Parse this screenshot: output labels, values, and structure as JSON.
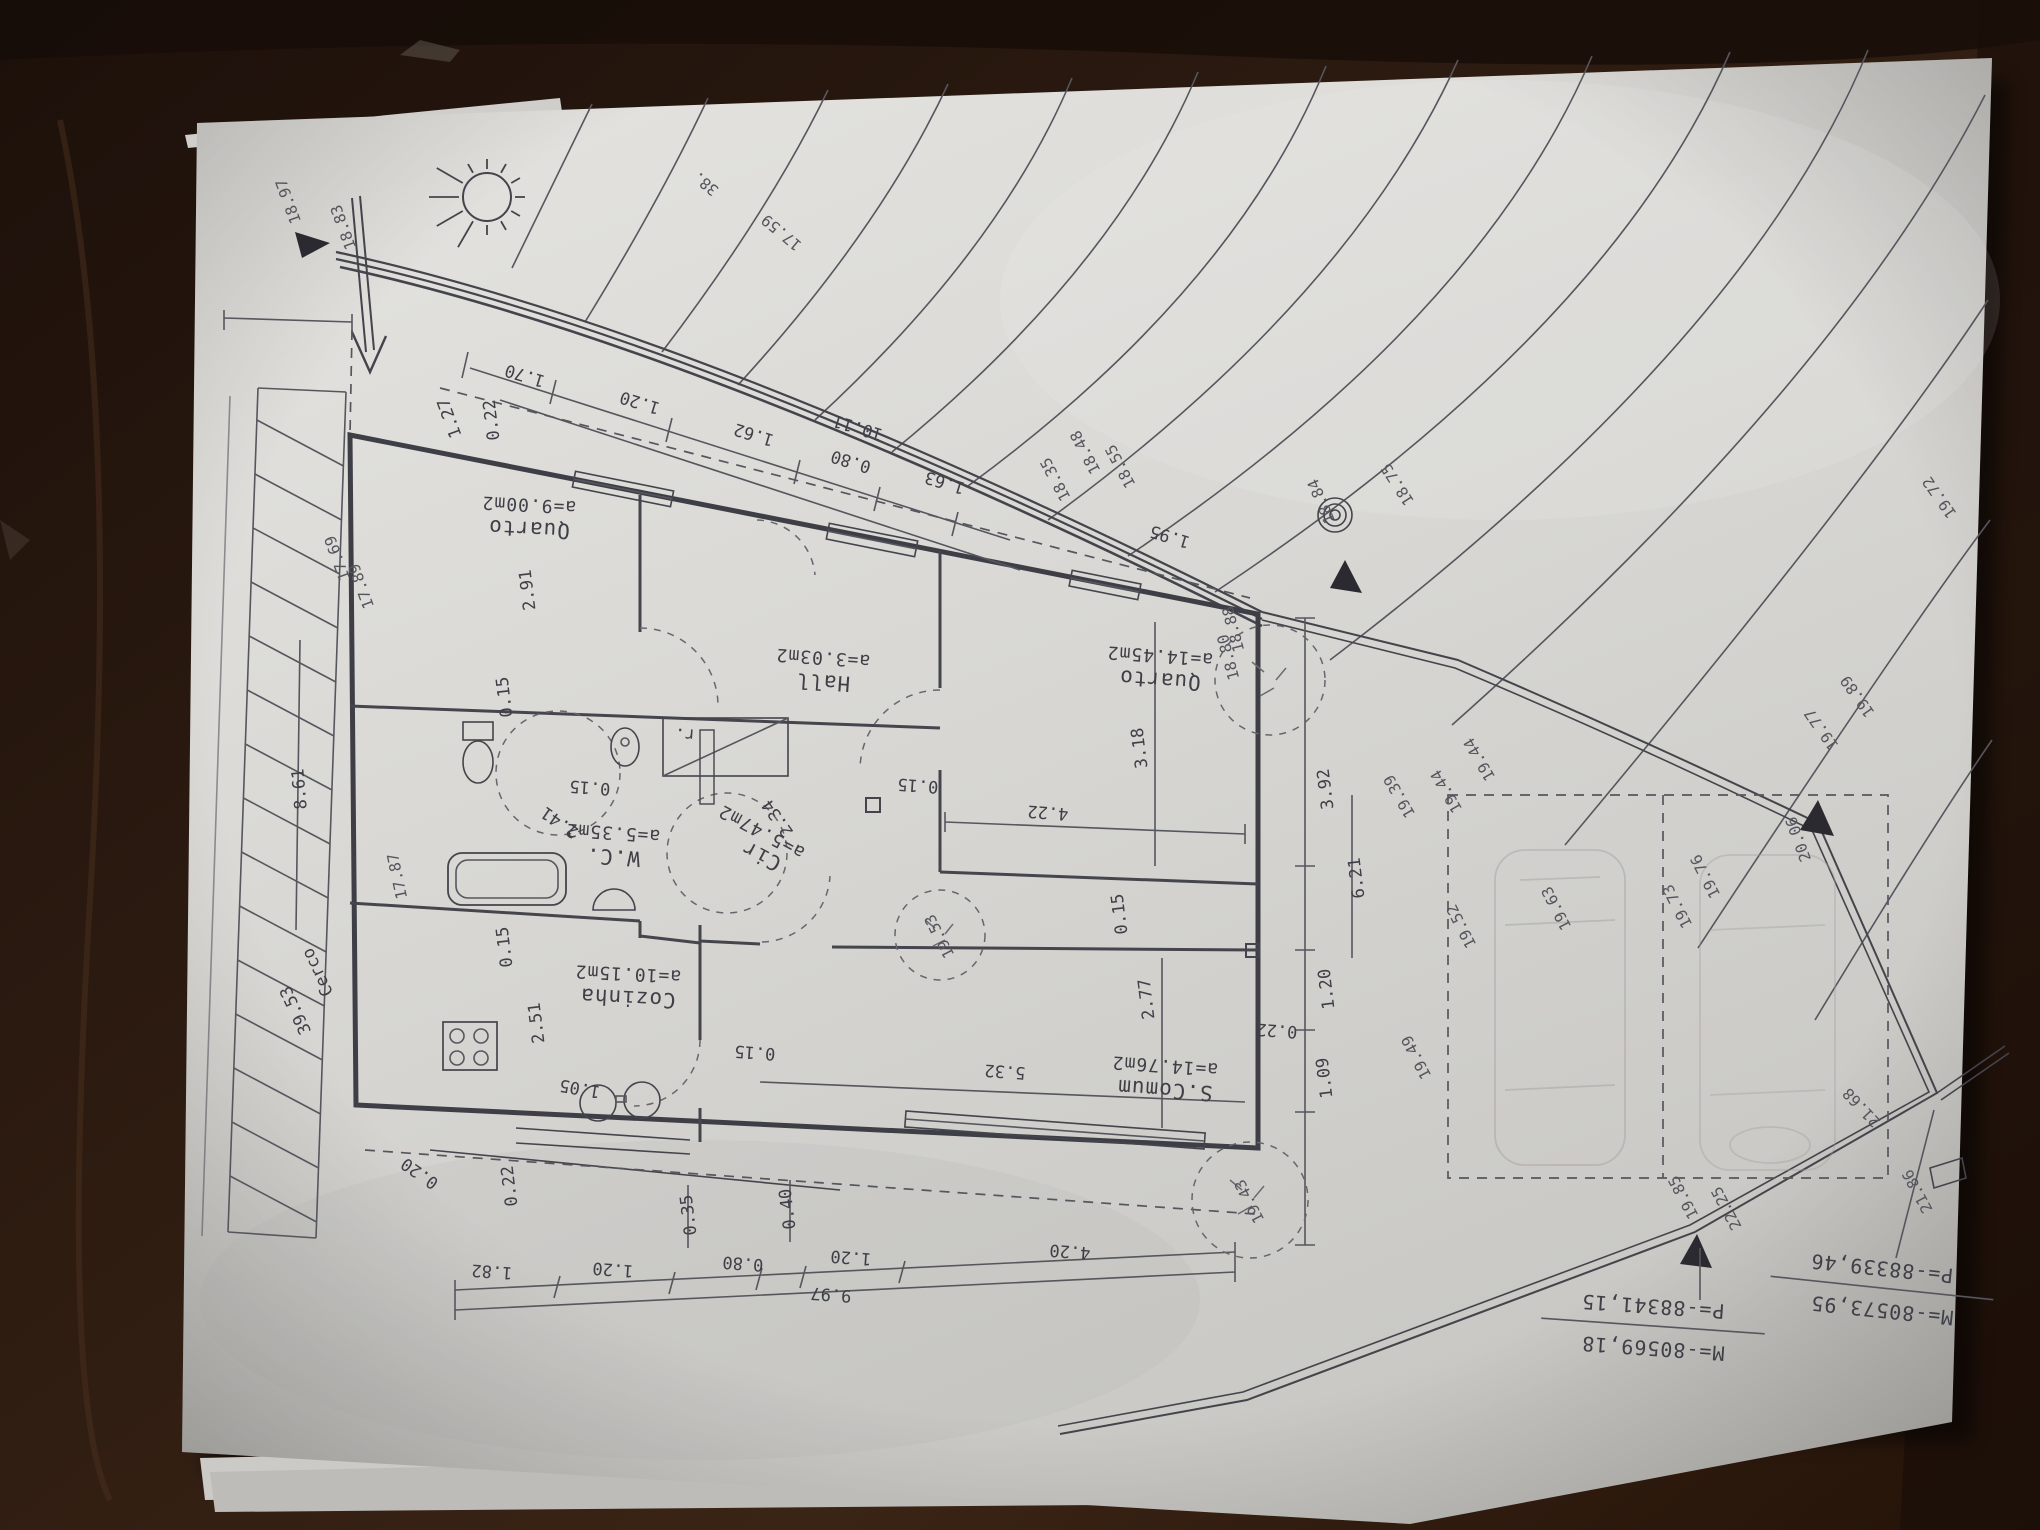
{
  "scene": {
    "description_labels": [],
    "paper_color": "#dbdad6",
    "wood_color": "#261710",
    "ink_color": "#3f3f47"
  },
  "plan": {
    "rooms": [
      {
        "name": "Quarto",
        "area": "a=9.00m2",
        "x": 529,
        "y": 516,
        "a": 183
      },
      {
        "name": "Hall",
        "area": "a=3.03m2",
        "x": 823,
        "y": 669,
        "a": 184
      },
      {
        "name": "Quarto",
        "area": "a=14.45m2",
        "x": 1160,
        "y": 667,
        "a": 184
      },
      {
        "name": "W.C.",
        "area": "a=5.35m2",
        "x": 613,
        "y": 844,
        "a": 184
      },
      {
        "name": "Cir",
        "area": "a=5.47m2",
        "x": 762,
        "y": 843,
        "a": 208
      },
      {
        "name": "Cozinha",
        "area": "a=10.15m2",
        "x": 628,
        "y": 985,
        "a": 183
      },
      {
        "name": "S.Comum",
        "area": "a=14.76m2",
        "x": 1165,
        "y": 1077,
        "a": 184
      }
    ],
    "dimensions": [
      {
        "t": "0.22",
        "x": 492,
        "y": 420,
        "a": 263
      },
      {
        "t": "1.70",
        "x": 525,
        "y": 375,
        "a": 197
      },
      {
        "t": "1.20",
        "x": 640,
        "y": 402,
        "a": 197
      },
      {
        "t": "1.62",
        "x": 754,
        "y": 434,
        "a": 197
      },
      {
        "t": "10.11",
        "x": 858,
        "y": 427,
        "a": 197
      },
      {
        "t": "0.80",
        "x": 851,
        "y": 461,
        "a": 197
      },
      {
        "t": "1.63",
        "x": 945,
        "y": 482,
        "a": 197
      },
      {
        "t": "1.95",
        "x": 1170,
        "y": 536,
        "a": 197
      },
      {
        "t": "2.91",
        "x": 528,
        "y": 590,
        "a": 263
      },
      {
        "t": "0.15",
        "x": 505,
        "y": 697,
        "a": 263
      },
      {
        "t": "0.15",
        "x": 590,
        "y": 787,
        "a": 184
      },
      {
        "t": "0.15",
        "x": 918,
        "y": 785,
        "a": 184
      },
      {
        "t": "r.",
        "x": 685,
        "y": 734,
        "a": 184
      },
      {
        "t": "3.18",
        "x": 1140,
        "y": 748,
        "a": 263
      },
      {
        "t": "4.22",
        "x": 1048,
        "y": 812,
        "a": 184
      },
      {
        "t": "2.41",
        "x": 560,
        "y": 822,
        "a": 215
      },
      {
        "t": "2.34",
        "x": 778,
        "y": 818,
        "a": 235
      },
      {
        "t": "0.15",
        "x": 505,
        "y": 947,
        "a": 263
      },
      {
        "t": "0.15",
        "x": 755,
        "y": 1052,
        "a": 184
      },
      {
        "t": "0.15",
        "x": 1120,
        "y": 914,
        "a": 263
      },
      {
        "t": "2.51",
        "x": 537,
        "y": 1023,
        "a": 263
      },
      {
        "t": "1.05",
        "x": 580,
        "y": 1088,
        "a": 190
      },
      {
        "t": "2.77",
        "x": 1147,
        "y": 999,
        "a": 263
      },
      {
        "t": "5.32",
        "x": 1005,
        "y": 1071,
        "a": 184
      },
      {
        "t": "3.92",
        "x": 1326,
        "y": 789,
        "a": 263
      },
      {
        "t": "6.21",
        "x": 1357,
        "y": 878,
        "a": 263
      },
      {
        "t": "1.20",
        "x": 1327,
        "y": 989,
        "a": 263
      },
      {
        "t": "0.22",
        "x": 1277,
        "y": 1030,
        "a": 184
      },
      {
        "t": "1.09",
        "x": 1325,
        "y": 1078,
        "a": 263
      },
      {
        "t": "0.22",
        "x": 510,
        "y": 1186,
        "a": 263
      },
      {
        "t": "0.20",
        "x": 420,
        "y": 1173,
        "a": 215
      },
      {
        "t": "1.82",
        "x": 492,
        "y": 1271,
        "a": 184
      },
      {
        "t": "1.20",
        "x": 613,
        "y": 1269,
        "a": 184
      },
      {
        "t": "0.80",
        "x": 743,
        "y": 1263,
        "a": 184
      },
      {
        "t": "0.35",
        "x": 689,
        "y": 1215,
        "a": 263
      },
      {
        "t": "0.40",
        "x": 788,
        "y": 1209,
        "a": 263
      },
      {
        "t": "1.20",
        "x": 851,
        "y": 1257,
        "a": 184
      },
      {
        "t": "4.20",
        "x": 1070,
        "y": 1251,
        "a": 184
      },
      {
        "t": "9.97",
        "x": 831,
        "y": 1294,
        "a": 184
      },
      {
        "t": "8.61",
        "x": 300,
        "y": 789,
        "a": 265
      },
      {
        "t": "39.53",
        "x": 296,
        "y": 1010,
        "a": 245
      },
      {
        "t": "Cerco",
        "x": 318,
        "y": 972,
        "a": 245
      },
      {
        "t": "1.27",
        "x": 450,
        "y": 418,
        "a": 250
      }
    ],
    "elevations": [
      {
        "t": "18.97",
        "x": 289,
        "y": 201,
        "a": 250
      },
      {
        "t": "18.83",
        "x": 344,
        "y": 227,
        "a": 250
      },
      {
        "t": "17.69",
        "x": 338,
        "y": 558,
        "a": 250
      },
      {
        "t": "17.89",
        "x": 362,
        "y": 586,
        "a": 250
      },
      {
        "t": "17.87",
        "x": 398,
        "y": 876,
        "a": 258
      },
      {
        "t": "18.35",
        "x": 1056,
        "y": 479,
        "a": 242
      },
      {
        "t": "18.48",
        "x": 1086,
        "y": 452,
        "a": 242
      },
      {
        "t": "18.55",
        "x": 1121,
        "y": 466,
        "a": 242
      },
      {
        "t": "18.88",
        "x": 1234,
        "y": 629,
        "a": 255
      },
      {
        "t": "18.80",
        "x": 1229,
        "y": 657,
        "a": 255
      },
      {
        "t": "18.84",
        "x": 1322,
        "y": 501,
        "a": 247
      },
      {
        "t": "18.75",
        "x": 1398,
        "y": 484,
        "a": 237
      },
      {
        "t": "19.44",
        "x": 1447,
        "y": 791,
        "a": 240
      },
      {
        "t": "19.44",
        "x": 1480,
        "y": 759,
        "a": 240
      },
      {
        "t": "19.39",
        "x": 1400,
        "y": 796,
        "a": 240
      },
      {
        "t": "19.52",
        "x": 1462,
        "y": 926,
        "a": 243
      },
      {
        "t": "19.49",
        "x": 1417,
        "y": 1057,
        "a": 243
      },
      {
        "t": "19.63",
        "x": 1557,
        "y": 908,
        "a": 243
      },
      {
        "t": "19.53",
        "x": 940,
        "y": 936,
        "a": 243
      },
      {
        "t": "19.43",
        "x": 1250,
        "y": 1201,
        "a": 243
      },
      {
        "t": "19.73",
        "x": 1678,
        "y": 906,
        "a": 243
      },
      {
        "t": "19.76",
        "x": 1706,
        "y": 876,
        "a": 243
      },
      {
        "t": "19.77",
        "x": 1822,
        "y": 729,
        "a": 235
      },
      {
        "t": "19.89",
        "x": 1858,
        "y": 696,
        "a": 235
      },
      {
        "t": "19.72",
        "x": 1940,
        "y": 497,
        "a": 235
      },
      {
        "t": "20.06",
        "x": 1799,
        "y": 839,
        "a": 250
      },
      {
        "t": "19.85",
        "x": 1684,
        "y": 1197,
        "a": 242
      },
      {
        "t": "22.25",
        "x": 1727,
        "y": 1208,
        "a": 242
      },
      {
        "t": "21.68",
        "x": 1862,
        "y": 1107,
        "a": 227
      },
      {
        "t": "21.86",
        "x": 1918,
        "y": 1191,
        "a": 242
      },
      {
        "t": "17.59",
        "x": 782,
        "y": 232,
        "a": 220
      },
      {
        "t": "38.",
        "x": 706,
        "y": 183,
        "a": 220
      }
    ],
    "survey_markers": [
      {
        "line1": "M=-80569,18",
        "line2": "P=-88341,15",
        "x": 1653,
        "y": 1326,
        "a": 184
      },
      {
        "line1": "M=-80573,95",
        "line2": "P=-88339,46",
        "x": 1882,
        "y": 1288,
        "a": 186
      }
    ]
  }
}
